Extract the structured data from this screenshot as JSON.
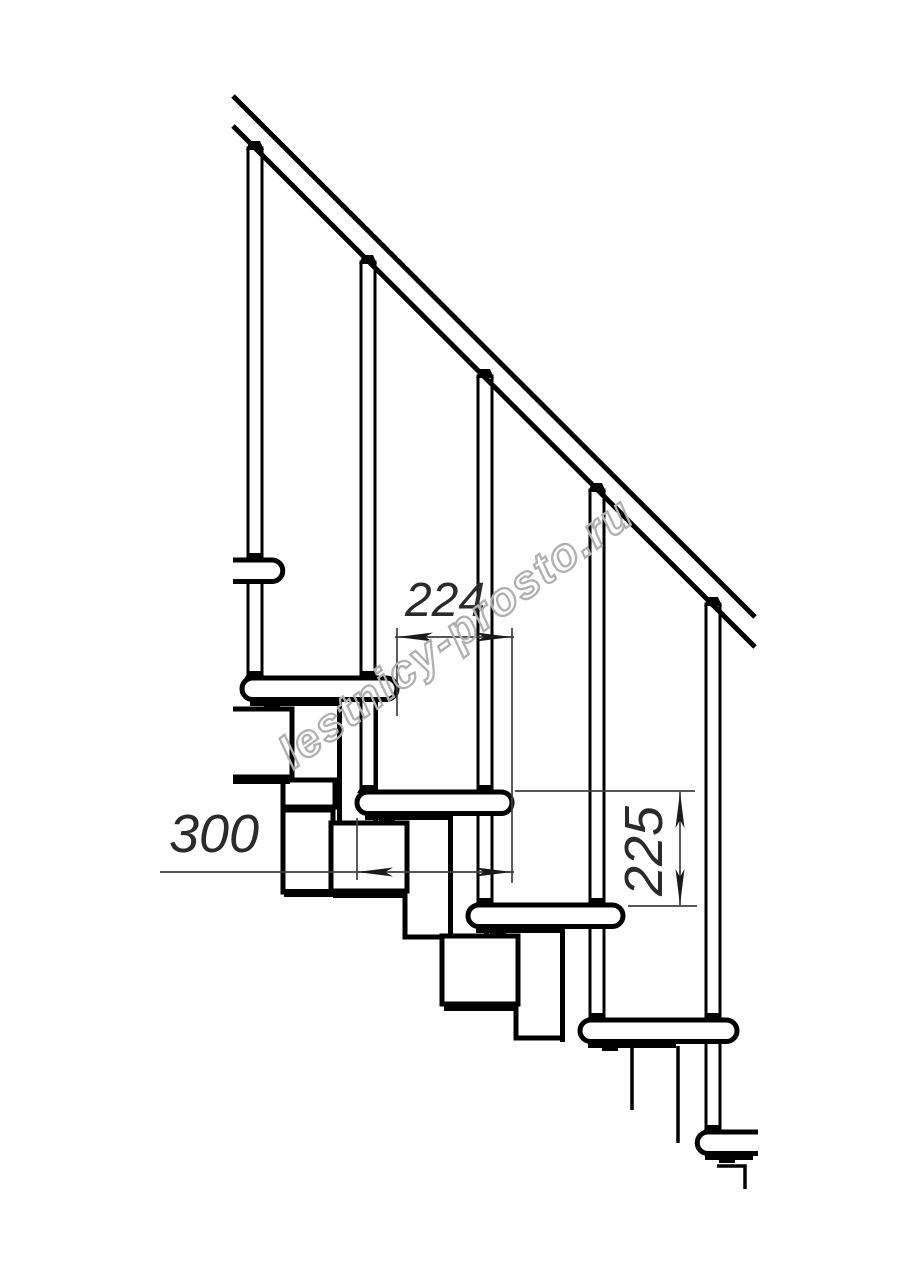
{
  "page": {
    "background": "#ffffff"
  },
  "drawing": {
    "description": "Side elevation fragment of a modular staircase with handrail, balusters, treads and support modules",
    "line_color": "#000000",
    "dimension_color": "#3f3f3f",
    "dimensions": {
      "step_run": {
        "value": "224",
        "orientation": "horizontal"
      },
      "tread_depth": {
        "value": "300",
        "orientation": "horizontal"
      },
      "step_rise": {
        "value": "225",
        "orientation": "vertical"
      }
    },
    "watermark": {
      "text": "lestnicy-prosto.ru",
      "color": "#b0b0b0"
    }
  }
}
